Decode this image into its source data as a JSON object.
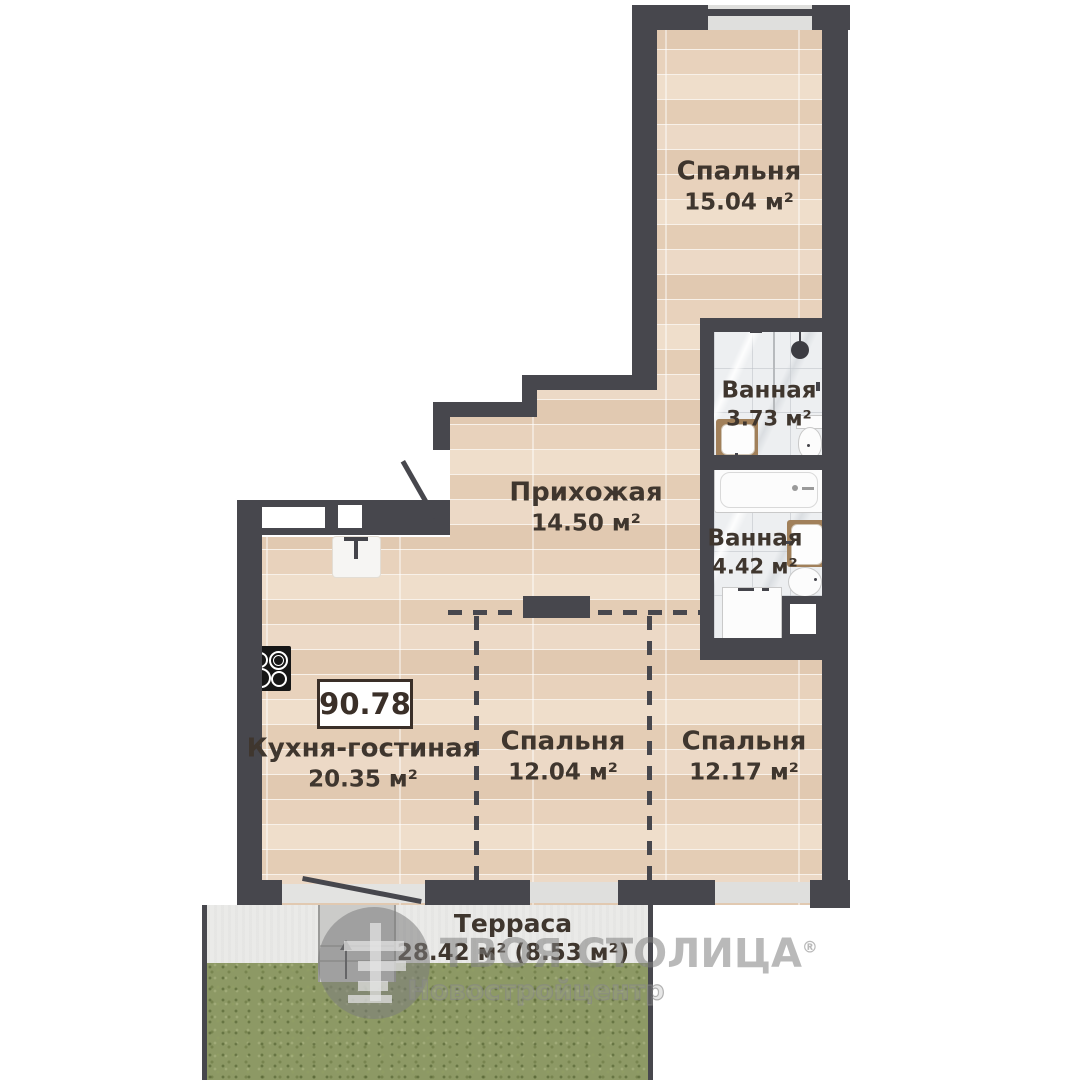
{
  "plan": {
    "total_area": "90.78",
    "rooms": [
      {
        "id": "bedroom-top",
        "name": "Спальня",
        "area": "15.04 м²"
      },
      {
        "id": "bathroom-1",
        "name": "Ванная",
        "area": "3.73 м²"
      },
      {
        "id": "hallway",
        "name": "Прихожая",
        "area": "14.50 м²"
      },
      {
        "id": "bathroom-2",
        "name": "Ванная",
        "area": "4.42 м²"
      },
      {
        "id": "kitchen-living",
        "name": "Кухня-гостиная",
        "area": "20.35 м²"
      },
      {
        "id": "bedroom-2",
        "name": "Спальня",
        "area": "12.04 м²"
      },
      {
        "id": "bedroom-3",
        "name": "Спальня",
        "area": "12.17 м²"
      },
      {
        "id": "terrace",
        "name": "Терраса",
        "area": "28.42 м² (8.53 м²)"
      }
    ],
    "watermark": {
      "brand": "ТВОЯ СТОЛИЦА",
      "reg_mark": "®",
      "subtitle": "Новостройцентр"
    },
    "icons": [
      "cooktop-icon",
      "kitchen-sink-icon",
      "shower-head-icon",
      "toilet-icon",
      "washbasin-icon",
      "bathtub-icon",
      "washing-machine-icon",
      "door-swing-icon",
      "stairs-up-arrow-icon",
      "brand-logo-icon"
    ],
    "colors": {
      "wall": "#47474d",
      "wood_floor": "#e8d4c0",
      "bathroom_tile": "#edeff1",
      "grass": "#8d9965",
      "vanity_wood": "#a1805a",
      "label_text": "#3f362e",
      "watermark": "#8c8c8c"
    }
  }
}
